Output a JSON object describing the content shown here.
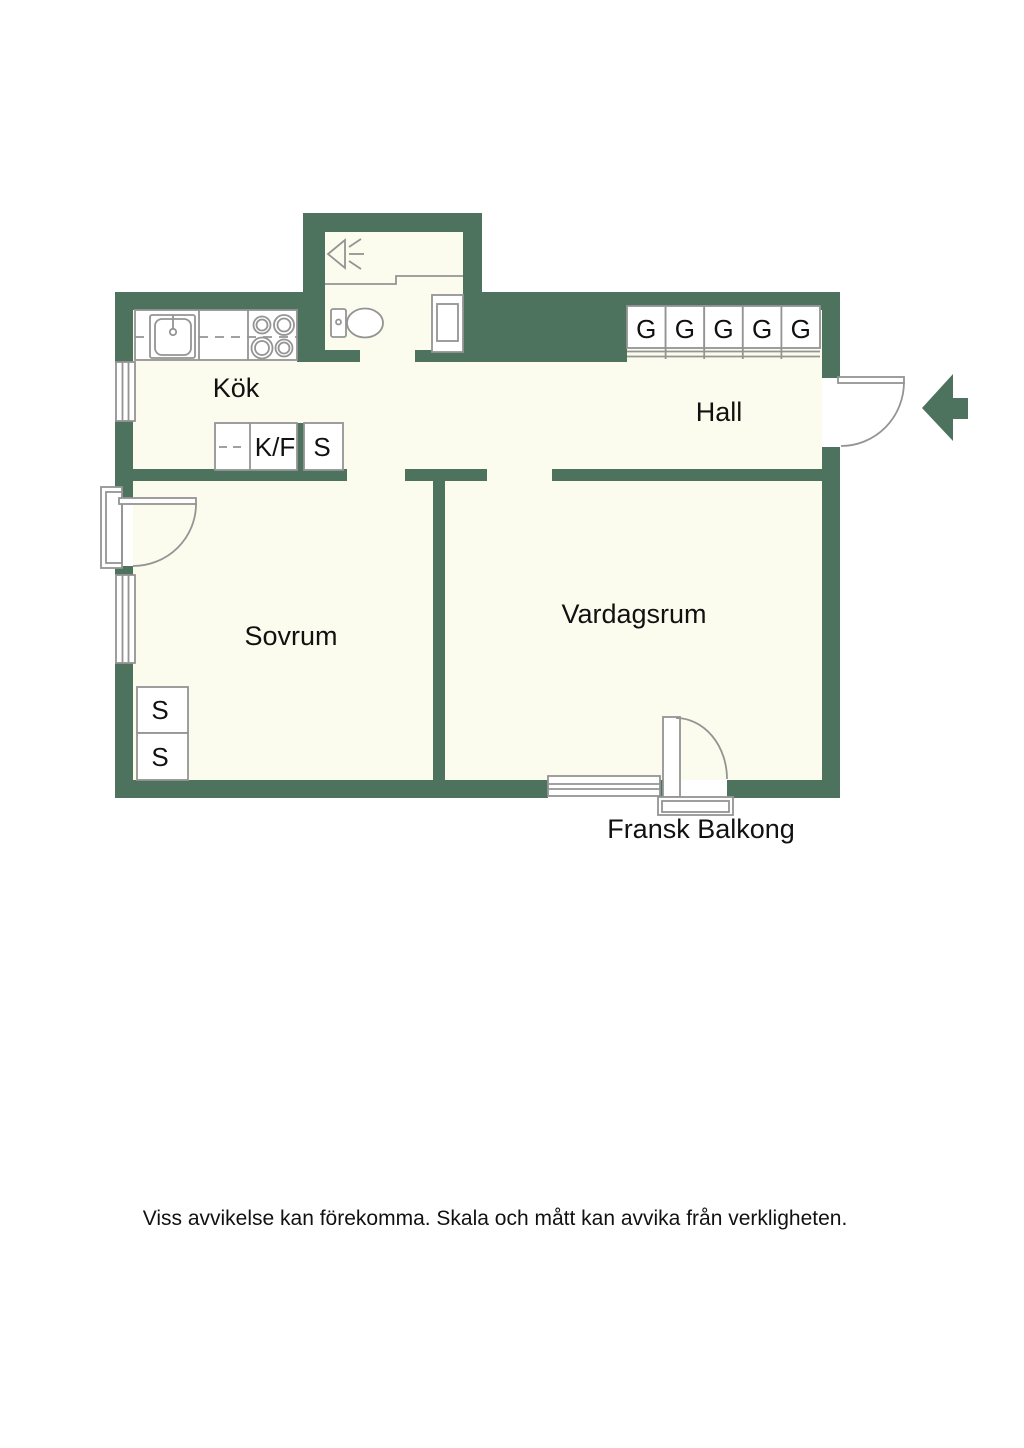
{
  "floorplan": {
    "colors": {
      "wall": "#4d735f",
      "floor": "#fcfcee",
      "outline": "#949494",
      "dash": "#b4b4b4",
      "text": "#111111"
    },
    "rooms": {
      "kok": "Kök",
      "hall": "Hall",
      "sovrum": "Sovrum",
      "vardagsrum": "Vardagsrum",
      "balcony": "Fransk Balkong"
    },
    "closets": {
      "kitchen_fridge_freezer": "K/F",
      "kitchen_cabinet": "S",
      "hall_wardrobes": [
        "G",
        "G",
        "G",
        "G",
        "G"
      ],
      "bedroom_closets": [
        "S",
        "S"
      ]
    },
    "icons": {
      "entrance_arrow": "left-arrow",
      "toilet": "toilet",
      "shower": "shower-head",
      "washing_machine": "washing-machine",
      "sink": "kitchen-sink",
      "stove": "stove-4-burners"
    }
  },
  "footer": {
    "disclaimer": "Viss avvikelse kan förekomma. Skala och mått kan avvika från verkligheten."
  }
}
